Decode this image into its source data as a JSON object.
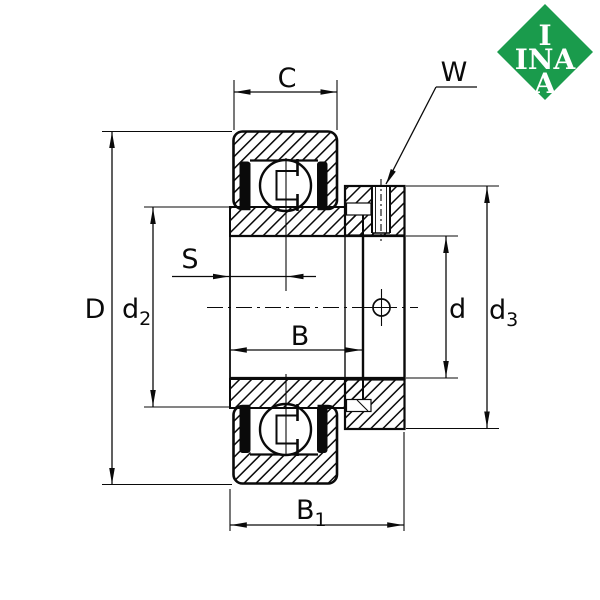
{
  "logo": {
    "lines": [
      "I",
      "INA",
      "A"
    ],
    "bg_color": "#1a9b4c",
    "text_color": "#ffffff"
  },
  "labels": {
    "C": {
      "main": "C"
    },
    "W": {
      "main": "W"
    },
    "D": {
      "main": "D"
    },
    "d2": {
      "main": "d",
      "sub": "2"
    },
    "S": {
      "main": "S"
    },
    "B": {
      "main": "B"
    },
    "d": {
      "main": "d"
    },
    "d3": {
      "main": "d",
      "sub": "3"
    },
    "B1": {
      "main": "B",
      "sub": "1"
    }
  },
  "drawing": {
    "line_color": "#0a0a0a",
    "background_color": "#ffffff"
  }
}
